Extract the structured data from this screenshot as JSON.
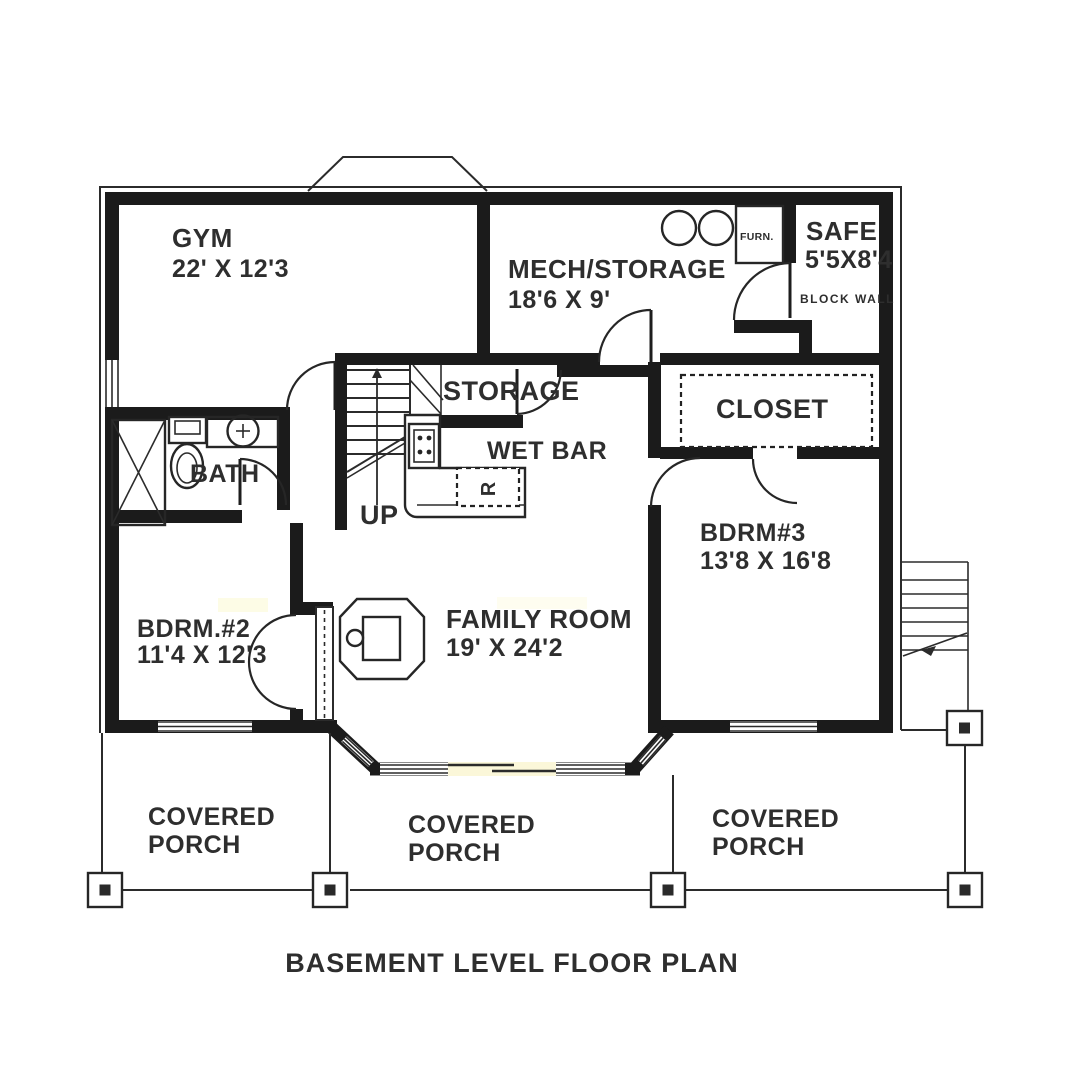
{
  "colors": {
    "ink": "#1b1b1b",
    "paper": "#ffffff",
    "text": "#2e2e2e"
  },
  "title": "BASEMENT LEVEL FLOOR PLAN",
  "rooms": {
    "gym": {
      "name": "GYM",
      "dims": "22' X 12'3"
    },
    "mech_storage": {
      "name": "MECH/STORAGE",
      "dims": "18'6 X 9'"
    },
    "safe": {
      "name": "SAFE",
      "dims": "5'5X8'4",
      "wall_note": "BLOCK WALL"
    },
    "furnace": {
      "label": "FURN."
    },
    "storage": {
      "name": "STORAGE"
    },
    "wet_bar": {
      "name": "WET BAR",
      "fridge_label": "R"
    },
    "bath": {
      "name": "BATH"
    },
    "stairs": {
      "label": "UP"
    },
    "closet": {
      "name": "CLOSET"
    },
    "bdrm3": {
      "name": "BDRM#3",
      "dims": "13'8 X 16'8"
    },
    "bdrm2": {
      "name": "BDRM.#2",
      "dims": "11'4 X 12'3"
    },
    "family_room": {
      "name": "FAMILY ROOM",
      "dims": "19' X 24'2"
    },
    "porch_left": {
      "line1": "COVERED",
      "line2": "PORCH"
    },
    "porch_center": {
      "line1": "COVERED",
      "line2": "PORCH"
    },
    "porch_right": {
      "line1": "COVERED",
      "line2": "PORCH"
    }
  }
}
